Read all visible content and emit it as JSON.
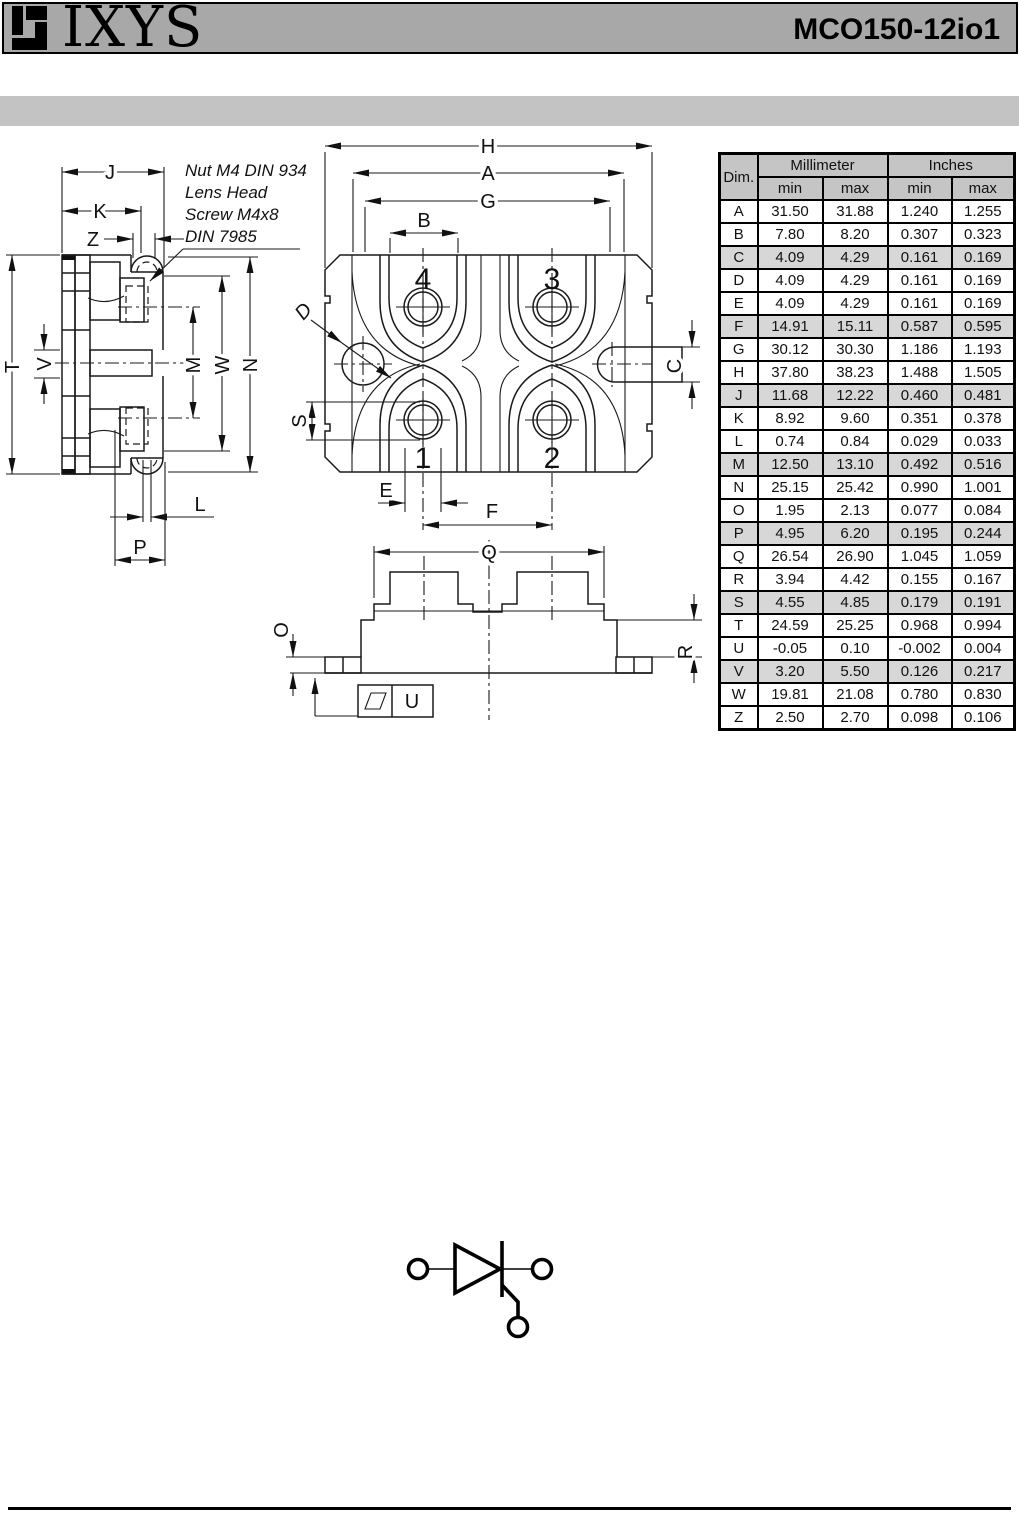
{
  "header": {
    "logo_text": "IXYS",
    "part_number": "MCO150-12io1"
  },
  "annotation": {
    "lines": [
      "Nut M4 DIN 934",
      "Lens Head",
      "Screw M4x8",
      "DIN 7985"
    ]
  },
  "drawing": {
    "labels": {
      "H": "H",
      "A": "A",
      "G": "G",
      "B": "B",
      "C": "C",
      "D": "D",
      "E": "E",
      "F": "F",
      "S": "S",
      "Q": "Q",
      "O": "O",
      "R": "R",
      "U": "U",
      "J": "J",
      "K": "K",
      "Z": "Z",
      "T": "T",
      "V": "V",
      "M": "M",
      "W": "W",
      "N": "N",
      "L": "L",
      "P": "P"
    },
    "terminals": {
      "t1": "1",
      "t2": "2",
      "t3": "3",
      "t4": "4"
    }
  },
  "table": {
    "dim_header": "Dim.",
    "group_headers": [
      "Millimeter",
      "Inches"
    ],
    "sub_headers": [
      "min",
      "max",
      "min",
      "max"
    ],
    "shaded_rows": [
      "C",
      "F",
      "J",
      "M",
      "P",
      "S",
      "V"
    ],
    "rows": [
      {
        "dim": "A",
        "mm_min": "31.50",
        "mm_max": "31.88",
        "in_min": "1.240",
        "in_max": "1.255"
      },
      {
        "dim": "B",
        "mm_min": "7.80",
        "mm_max": "8.20",
        "in_min": "0.307",
        "in_max": "0.323"
      },
      {
        "dim": "C",
        "mm_min": "4.09",
        "mm_max": "4.29",
        "in_min": "0.161",
        "in_max": "0.169"
      },
      {
        "dim": "D",
        "mm_min": "4.09",
        "mm_max": "4.29",
        "in_min": "0.161",
        "in_max": "0.169"
      },
      {
        "dim": "E",
        "mm_min": "4.09",
        "mm_max": "4.29",
        "in_min": "0.161",
        "in_max": "0.169"
      },
      {
        "dim": "F",
        "mm_min": "14.91",
        "mm_max": "15.11",
        "in_min": "0.587",
        "in_max": "0.595"
      },
      {
        "dim": "G",
        "mm_min": "30.12",
        "mm_max": "30.30",
        "in_min": "1.186",
        "in_max": "1.193"
      },
      {
        "dim": "H",
        "mm_min": "37.80",
        "mm_max": "38.23",
        "in_min": "1.488",
        "in_max": "1.505"
      },
      {
        "dim": "J",
        "mm_min": "11.68",
        "mm_max": "12.22",
        "in_min": "0.460",
        "in_max": "0.481"
      },
      {
        "dim": "K",
        "mm_min": "8.92",
        "mm_max": "9.60",
        "in_min": "0.351",
        "in_max": "0.378"
      },
      {
        "dim": "L",
        "mm_min": "0.74",
        "mm_max": "0.84",
        "in_min": "0.029",
        "in_max": "0.033"
      },
      {
        "dim": "M",
        "mm_min": "12.50",
        "mm_max": "13.10",
        "in_min": "0.492",
        "in_max": "0.516"
      },
      {
        "dim": "N",
        "mm_min": "25.15",
        "mm_max": "25.42",
        "in_min": "0.990",
        "in_max": "1.001"
      },
      {
        "dim": "O",
        "mm_min": "1.95",
        "mm_max": "2.13",
        "in_min": "0.077",
        "in_max": "0.084"
      },
      {
        "dim": "P",
        "mm_min": "4.95",
        "mm_max": "6.20",
        "in_min": "0.195",
        "in_max": "0.244"
      },
      {
        "dim": "Q",
        "mm_min": "26.54",
        "mm_max": "26.90",
        "in_min": "1.045",
        "in_max": "1.059"
      },
      {
        "dim": "R",
        "mm_min": "3.94",
        "mm_max": "4.42",
        "in_min": "0.155",
        "in_max": "0.167"
      },
      {
        "dim": "S",
        "mm_min": "4.55",
        "mm_max": "4.85",
        "in_min": "0.179",
        "in_max": "0.191"
      },
      {
        "dim": "T",
        "mm_min": "24.59",
        "mm_max": "25.25",
        "in_min": "0.968",
        "in_max": "0.994"
      },
      {
        "dim": "U",
        "mm_min": "-0.05",
        "mm_max": "0.10",
        "in_min": "-0.002",
        "in_max": "0.004"
      },
      {
        "dim": "V",
        "mm_min": "3.20",
        "mm_max": "5.50",
        "in_min": "0.126",
        "in_max": "0.217"
      },
      {
        "dim": "W",
        "mm_min": "19.81",
        "mm_max": "21.08",
        "in_min": "0.780",
        "in_max": "0.830"
      },
      {
        "dim": "Z",
        "mm_min": "2.50",
        "mm_max": "2.70",
        "in_min": "0.098",
        "in_max": "0.106"
      }
    ]
  },
  "colors": {
    "header_bar": "#a8a8a8",
    "banner_bar": "#c3c3c3",
    "table_header_bg": "#c5c5c5",
    "table_shaded_bg": "#d7d7d7",
    "line": "#1a1a1a"
  }
}
